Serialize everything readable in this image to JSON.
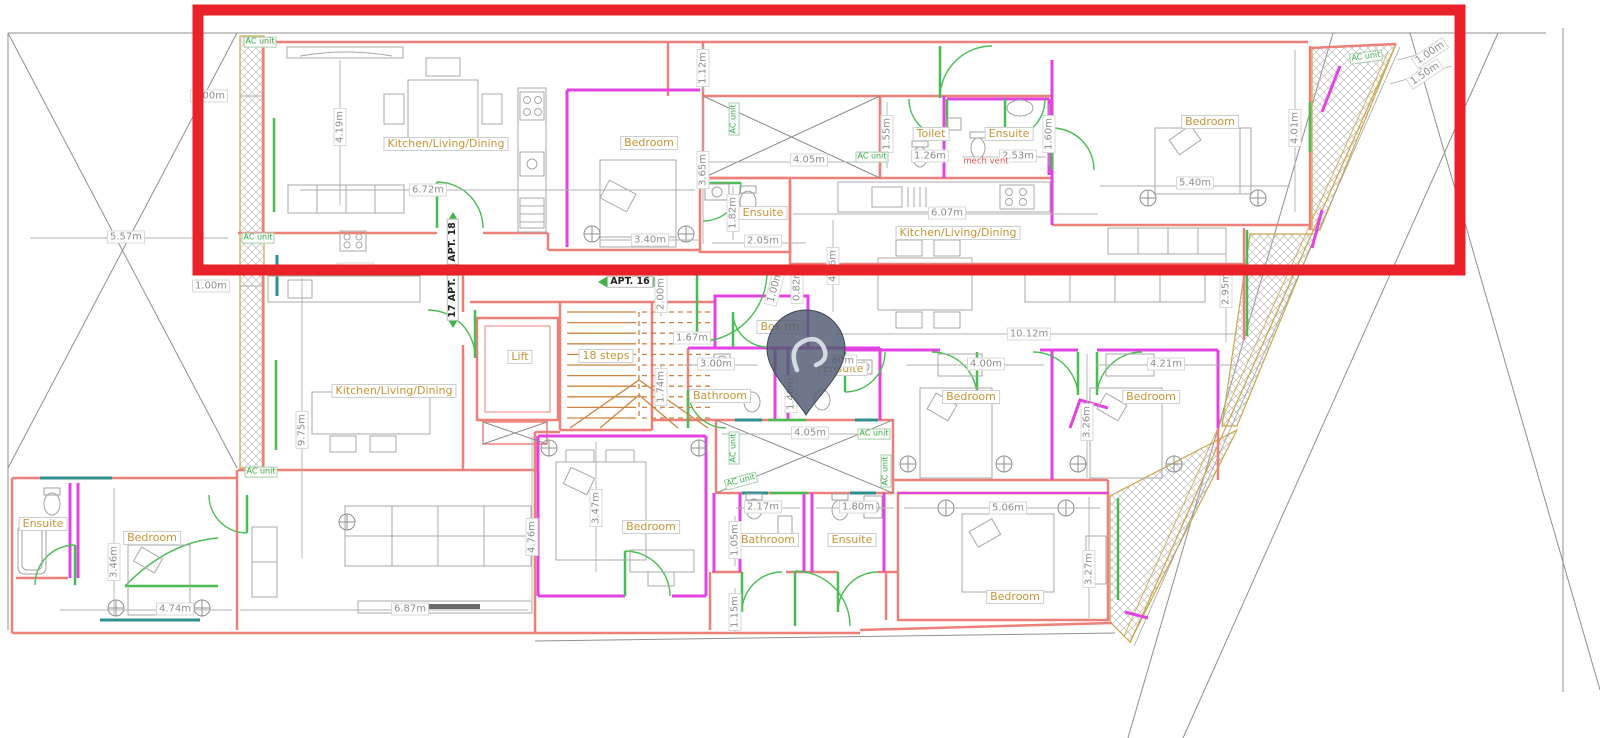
{
  "document": {
    "type": "architectural floor plan",
    "highlight": "red rectangle around top-floor apartment band",
    "marker": "location pin over central hallway"
  },
  "colors": {
    "highlight_red": "#e92128",
    "wall_red": "#ee807a",
    "wall_magenta": "#e243e2",
    "door_green": "#49bd52",
    "window_teal": "#2f8f8f",
    "hatch_border_tan": "#c9a84c",
    "stairs_orange": "#cd8440",
    "room_text": "#c49536",
    "dimension_text": "#8d8d8d",
    "ac_text": "#33ad44",
    "pin_fill": "#4e5a70"
  },
  "labels": {
    "rooms": [
      {
        "text": "Kitchen/Living/Dining",
        "x": 446,
        "y": 144
      },
      {
        "text": "Bedroom",
        "x": 649,
        "y": 143
      },
      {
        "text": "Ensuite",
        "x": 763,
        "y": 213
      },
      {
        "text": "Toilet",
        "x": 931,
        "y": 134
      },
      {
        "text": "Ensuite",
        "x": 1009,
        "y": 134
      },
      {
        "text": "Bedroom",
        "x": 1210,
        "y": 122
      },
      {
        "text": "Kitchen/Living/Dining",
        "x": 958,
        "y": 233
      },
      {
        "text": "Lift",
        "x": 520,
        "y": 357
      },
      {
        "text": "18 steps",
        "x": 606,
        "y": 356
      },
      {
        "text": "Box rm",
        "x": 780,
        "y": 327
      },
      {
        "text": "Bathroom",
        "x": 720,
        "y": 396
      },
      {
        "text": "Ensuite",
        "x": 843,
        "y": 369
      },
      {
        "text": "Kitchen/Living/Dining",
        "x": 394,
        "y": 391
      },
      {
        "text": "Bedroom",
        "x": 971,
        "y": 397
      },
      {
        "text": "Bedroom",
        "x": 1151,
        "y": 397
      },
      {
        "text": "Ensuite",
        "x": 43,
        "y": 524
      },
      {
        "text": "Bedroom",
        "x": 152,
        "y": 538
      },
      {
        "text": "Bedroom",
        "x": 651,
        "y": 527
      },
      {
        "text": "Bathroom",
        "x": 768,
        "y": 540
      },
      {
        "text": "Ensuite",
        "x": 852,
        "y": 540
      },
      {
        "text": "Bedroom",
        "x": 1015,
        "y": 597
      }
    ],
    "dimensions": [
      {
        "text": "1.00m",
        "x": 209,
        "y": 96
      },
      {
        "text": "5.57m",
        "x": 126,
        "y": 237
      },
      {
        "text": "1.00m",
        "x": 211,
        "y": 286
      },
      {
        "text": "4.19m",
        "x": 340,
        "y": 127,
        "rot": -90
      },
      {
        "text": "6.72m",
        "x": 428,
        "y": 190
      },
      {
        "text": "3.28m",
        "x": 355,
        "y": 269
      },
      {
        "text": "1.12m",
        "x": 703,
        "y": 68,
        "rot": -90
      },
      {
        "text": "3.65m",
        "x": 703,
        "y": 170,
        "rot": -90
      },
      {
        "text": "3.40m",
        "x": 650,
        "y": 240
      },
      {
        "text": "1.82m",
        "x": 733,
        "y": 213,
        "rot": -90
      },
      {
        "text": "2.05m",
        "x": 763,
        "y": 241
      },
      {
        "text": "4.05m",
        "x": 809,
        "y": 160
      },
      {
        "text": "1.55m",
        "x": 887,
        "y": 134,
        "rot": -90
      },
      {
        "text": "1.26m",
        "x": 930,
        "y": 156
      },
      {
        "text": "2.53m",
        "x": 1018,
        "y": 156
      },
      {
        "text": "1.60m",
        "x": 1049,
        "y": 134,
        "rot": -90
      },
      {
        "text": "6.07m",
        "x": 947,
        "y": 213
      },
      {
        "text": "4.06m",
        "x": 833,
        "y": 266,
        "rot": -90
      },
      {
        "text": "5.40m",
        "x": 1195,
        "y": 183
      },
      {
        "text": "4.01m",
        "x": 1295,
        "y": 128,
        "rot": -90
      },
      {
        "text": "1.00m",
        "x": 1430,
        "y": 53,
        "rot": -34
      },
      {
        "text": "1.50m",
        "x": 1425,
        "y": 74,
        "rot": -34
      },
      {
        "text": "2.95m",
        "x": 1226,
        "y": 289,
        "rot": -90
      },
      {
        "text": "9.75m",
        "x": 302,
        "y": 430,
        "rot": -90
      },
      {
        "text": "2.00m",
        "x": 661,
        "y": 294,
        "rot": -90
      },
      {
        "text": "1.67m",
        "x": 692,
        "y": 338
      },
      {
        "text": "1.74m",
        "x": 661,
        "y": 387,
        "rot": -90
      },
      {
        "text": "3.00m",
        "x": 716,
        "y": 364
      },
      {
        "text": "1.00m",
        "x": 775,
        "y": 287,
        "rot": -75
      },
      {
        "text": "0.82m",
        "x": 797,
        "y": 285,
        "rot": -90
      },
      {
        "text": "2.60m",
        "x": 838,
        "y": 361
      },
      {
        "text": "1.48m",
        "x": 791,
        "y": 394,
        "rot": -90
      },
      {
        "text": "4.00m",
        "x": 986,
        "y": 364
      },
      {
        "text": "10.12m",
        "x": 1029,
        "y": 334
      },
      {
        "text": "4.21m",
        "x": 1166,
        "y": 364
      },
      {
        "text": "3.26m",
        "x": 1087,
        "y": 422,
        "rot": -90
      },
      {
        "text": "4.05m",
        "x": 810,
        "y": 433
      },
      {
        "text": "2.17m",
        "x": 763,
        "y": 507
      },
      {
        "text": "1.80m",
        "x": 858,
        "y": 507
      },
      {
        "text": "1.05m",
        "x": 735,
        "y": 540,
        "rot": -90
      },
      {
        "text": "1.15m",
        "x": 735,
        "y": 612,
        "rot": -90
      },
      {
        "text": "3.47m",
        "x": 596,
        "y": 508,
        "rot": -90
      },
      {
        "text": "4.76m",
        "x": 532,
        "y": 537,
        "rot": -90
      },
      {
        "text": "3.46m",
        "x": 114,
        "y": 562,
        "rot": -90
      },
      {
        "text": "4.74m",
        "x": 175,
        "y": 609
      },
      {
        "text": "6.87m",
        "x": 410,
        "y": 609
      },
      {
        "text": "5.06m",
        "x": 1008,
        "y": 508
      },
      {
        "text": "3.27m",
        "x": 1089,
        "y": 569,
        "rot": -90
      }
    ],
    "ac_units": [
      {
        "text": "AC unit",
        "x": 260,
        "y": 42
      },
      {
        "text": "AC unit",
        "x": 258,
        "y": 238
      },
      {
        "text": "AC unit",
        "x": 261,
        "y": 472
      },
      {
        "text": "AC unit",
        "x": 734,
        "y": 119,
        "rot": -90
      },
      {
        "text": "AC unit",
        "x": 872,
        "y": 157
      },
      {
        "text": "AC unit",
        "x": 1366,
        "y": 57,
        "rot": -8
      },
      {
        "text": "AC unit",
        "x": 874,
        "y": 434
      },
      {
        "text": "AC unit",
        "x": 734,
        "y": 448,
        "rot": -90
      },
      {
        "text": "AC unit",
        "x": 741,
        "y": 481,
        "rot": -15
      },
      {
        "text": "AC unit",
        "x": 886,
        "y": 471,
        "rot": -90
      }
    ],
    "apt_tags": [
      {
        "text": "APT. 18",
        "x": 453,
        "y": 242,
        "rot": -90
      },
      {
        "text": "17 APT.",
        "x": 453,
        "y": 298,
        "rot": -90
      },
      {
        "text": "APT. 16",
        "x": 630,
        "y": 282
      }
    ],
    "annotations": [
      {
        "text": "mech vent",
        "x": 986,
        "y": 162
      }
    ]
  }
}
